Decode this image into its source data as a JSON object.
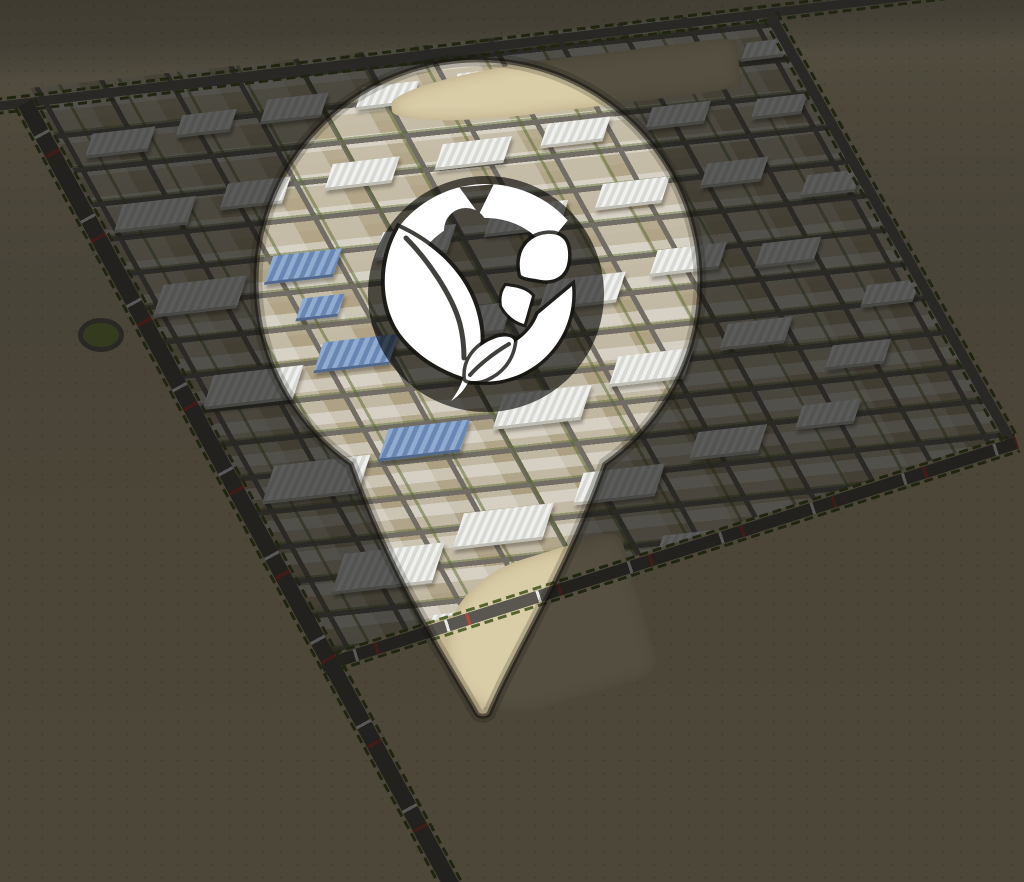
{
  "image": {
    "width": 1024,
    "height": 882
  },
  "overlay": {
    "color": "#000000",
    "opacity": 0.62
  },
  "pin": {
    "icon": "location-pin-icon",
    "fill": "window-to-bright-scene",
    "logo": {
      "color": "#ffffff",
      "backdrop": "dark-disc",
      "elements": [
        "gear-icon",
        "drop-icon",
        "g-letterform-icon",
        "leaf-icon",
        "sprout-icon",
        "small-leaf-icon"
      ]
    }
  },
  "scene": {
    "kind": "aerial-3d-render-eco-industrial-city",
    "palette": {
      "desert_sand": "#c6b893",
      "far_desert": "#a79a80",
      "city_ground": "#b3a78a",
      "road_asphalt": "#6e6b63",
      "building_white": "#e9eae6",
      "solar_roof_blue": "#7d9cc4",
      "tree_green": "#57652f",
      "sand_lot": "#d9cda8"
    },
    "roundabout": {
      "x": 78,
      "y": 318,
      "w": 46,
      "h": 34
    },
    "sand_lots": [
      {
        "x": 390,
        "y": 58,
        "w": 350,
        "h": 52,
        "angle": -7
      },
      {
        "x": 445,
        "y": 556,
        "w": 200,
        "h": 150,
        "angle": -17
      }
    ],
    "roads": [
      {
        "name": "north-boundary-road",
        "x": -20,
        "y": 104,
        "len": 1060,
        "w": 9,
        "angle": -6.9,
        "cars": false
      },
      {
        "name": "northeast-boundary-road",
        "x": 770,
        "y": 10,
        "len": 490,
        "w": 10,
        "angle": 60.5,
        "cars": false
      },
      {
        "name": "south-boundary-road",
        "x": 322,
        "y": 660,
        "len": 730,
        "w": 12,
        "angle": -17.8,
        "cars": true
      },
      {
        "name": "southwest-highway",
        "x": 25,
        "y": 95,
        "len": 905,
        "w": 16,
        "angle": 61.4,
        "cars": true
      }
    ],
    "buildings": [
      {
        "x": 90,
        "y": 130,
        "w": 60,
        "h": 22,
        "roof": "white"
      },
      {
        "x": 180,
        "y": 112,
        "w": 52,
        "h": 20,
        "roof": "white"
      },
      {
        "x": 265,
        "y": 96,
        "w": 58,
        "h": 22,
        "roof": "white"
      },
      {
        "x": 360,
        "y": 84,
        "w": 54,
        "h": 20,
        "roof": "white"
      },
      {
        "x": 455,
        "y": 70,
        "w": 60,
        "h": 22,
        "roof": "white"
      },
      {
        "x": 555,
        "y": 58,
        "w": 56,
        "h": 20,
        "roof": "white"
      },
      {
        "x": 655,
        "y": 48,
        "w": 50,
        "h": 18,
        "roof": "white"
      },
      {
        "x": 745,
        "y": 40,
        "w": 44,
        "h": 16,
        "roof": "white"
      },
      {
        "x": 120,
        "y": 200,
        "w": 70,
        "h": 26,
        "roof": "white"
      },
      {
        "x": 225,
        "y": 180,
        "w": 60,
        "h": 24,
        "roof": "white"
      },
      {
        "x": 330,
        "y": 160,
        "w": 64,
        "h": 24,
        "roof": "white"
      },
      {
        "x": 440,
        "y": 140,
        "w": 66,
        "h": 24,
        "roof": "white"
      },
      {
        "x": 545,
        "y": 120,
        "w": 60,
        "h": 22,
        "roof": "white"
      },
      {
        "x": 650,
        "y": 104,
        "w": 56,
        "h": 20,
        "roof": "white"
      },
      {
        "x": 755,
        "y": 96,
        "w": 48,
        "h": 18,
        "roof": "white"
      },
      {
        "x": 850,
        "y": 122,
        "w": 44,
        "h": 16,
        "roof": "white"
      },
      {
        "x": 160,
        "y": 280,
        "w": 80,
        "h": 30,
        "roof": "white"
      },
      {
        "x": 270,
        "y": 252,
        "w": 66,
        "h": 26,
        "roof": "solar"
      },
      {
        "x": 380,
        "y": 228,
        "w": 70,
        "h": 26,
        "roof": "white"
      },
      {
        "x": 490,
        "y": 204,
        "w": 72,
        "h": 26,
        "roof": "white"
      },
      {
        "x": 600,
        "y": 180,
        "w": 64,
        "h": 24,
        "roof": "white"
      },
      {
        "x": 705,
        "y": 160,
        "w": 58,
        "h": 22,
        "roof": "white"
      },
      {
        "x": 805,
        "y": 172,
        "w": 52,
        "h": 20,
        "roof": "white"
      },
      {
        "x": 890,
        "y": 212,
        "w": 46,
        "h": 18,
        "roof": "white"
      },
      {
        "x": 210,
        "y": 370,
        "w": 86,
        "h": 32,
        "roof": "white"
      },
      {
        "x": 320,
        "y": 338,
        "w": 72,
        "h": 28,
        "roof": "solar"
      },
      {
        "x": 300,
        "y": 296,
        "w": 40,
        "h": 20,
        "roof": "solar"
      },
      {
        "x": 430,
        "y": 306,
        "w": 76,
        "h": 28,
        "roof": "white"
      },
      {
        "x": 545,
        "y": 276,
        "w": 74,
        "h": 28,
        "roof": "white"
      },
      {
        "x": 655,
        "y": 246,
        "w": 66,
        "h": 24,
        "roof": "white"
      },
      {
        "x": 760,
        "y": 240,
        "w": 56,
        "h": 22,
        "roof": "white"
      },
      {
        "x": 865,
        "y": 282,
        "w": 50,
        "h": 20,
        "roof": "white"
      },
      {
        "x": 270,
        "y": 460,
        "w": 92,
        "h": 36,
        "roof": "white"
      },
      {
        "x": 385,
        "y": 424,
        "w": 78,
        "h": 30,
        "roof": "solar"
      },
      {
        "x": 500,
        "y": 390,
        "w": 84,
        "h": 32,
        "roof": "white"
      },
      {
        "x": 615,
        "y": 352,
        "w": 72,
        "h": 28,
        "roof": "white"
      },
      {
        "x": 725,
        "y": 320,
        "w": 62,
        "h": 24,
        "roof": "white"
      },
      {
        "x": 830,
        "y": 342,
        "w": 56,
        "h": 22,
        "roof": "white"
      },
      {
        "x": 340,
        "y": 548,
        "w": 96,
        "h": 38,
        "roof": "white"
      },
      {
        "x": 460,
        "y": 508,
        "w": 86,
        "h": 34,
        "roof": "white"
      },
      {
        "x": 580,
        "y": 468,
        "w": 78,
        "h": 30,
        "roof": "white"
      },
      {
        "x": 695,
        "y": 428,
        "w": 66,
        "h": 26,
        "roof": "white"
      },
      {
        "x": 800,
        "y": 402,
        "w": 56,
        "h": 22,
        "roof": "white"
      },
      {
        "x": 430,
        "y": 610,
        "w": 80,
        "h": 30,
        "roof": "white"
      },
      {
        "x": 545,
        "y": 572,
        "w": 70,
        "h": 28,
        "roof": "white"
      },
      {
        "x": 660,
        "y": 532,
        "w": 60,
        "h": 24,
        "roof": "white"
      }
    ]
  }
}
